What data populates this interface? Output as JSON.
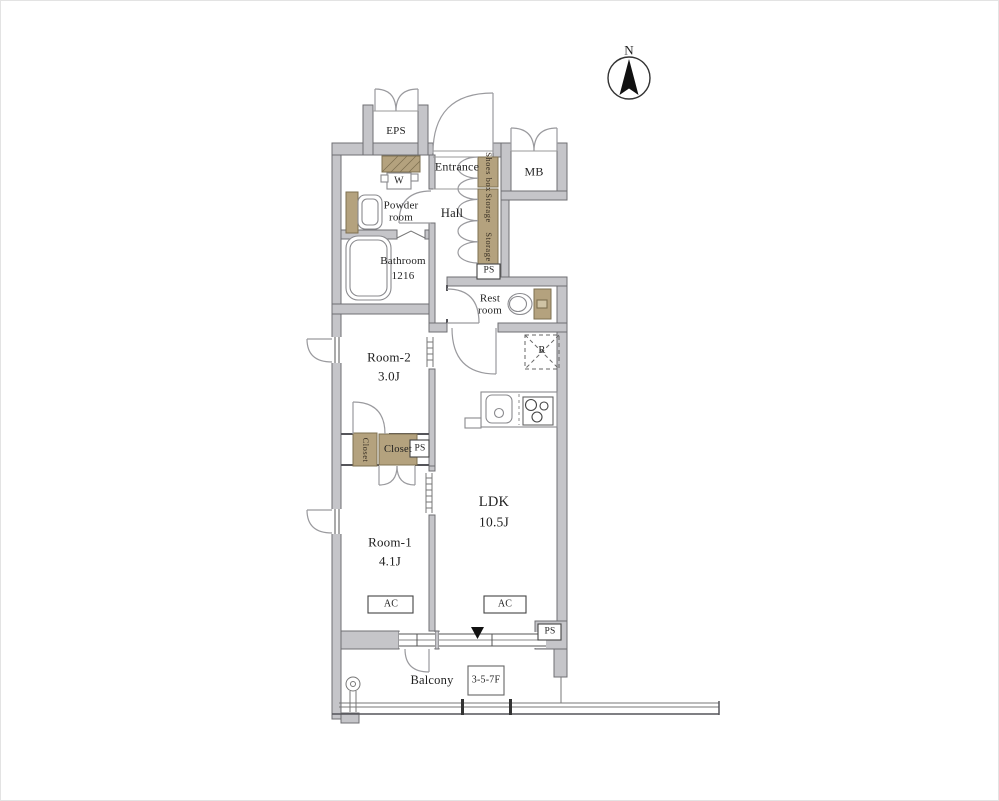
{
  "colors": {
    "wall_fill": "#c5c5c9",
    "wall_line": "#6f6f73",
    "wood_fill": "#b4a27e",
    "wood_line": "#7e7050",
    "thin_line": "#55555a",
    "arc_line": "#9a9a9e",
    "text": "#1f1f1f"
  },
  "compass": {
    "north_label": "N"
  },
  "service": {
    "eps": "EPS",
    "mb": "MB",
    "ps_hall": "PS",
    "ps_closet": "PS",
    "ps_ldk": "PS"
  },
  "entry": {
    "entrance": "Entrance",
    "shoes_box": "Shoes box",
    "hall": "Hall",
    "storage_upper": "Storage",
    "storage_lower": "Storage"
  },
  "sanitary": {
    "washer": "W",
    "powder_room": "Powder room",
    "bathroom": "Bathroom",
    "bathroom_size": "1216",
    "rest_room": "Rest room"
  },
  "kitchen": {
    "refrigerator": "R"
  },
  "rooms": {
    "room2": "Room-2",
    "room2_size": "3.0J",
    "room1": "Room-1",
    "room1_size": "4.1J",
    "ldk": "LDK",
    "ldk_size": "10.5J",
    "closet_side": "Closet",
    "closet_main": "Closet"
  },
  "equipment": {
    "ac_room1": "AC",
    "ac_ldk": "AC"
  },
  "outdoor": {
    "balcony": "Balcony",
    "floor_note": "3-5-7F"
  }
}
